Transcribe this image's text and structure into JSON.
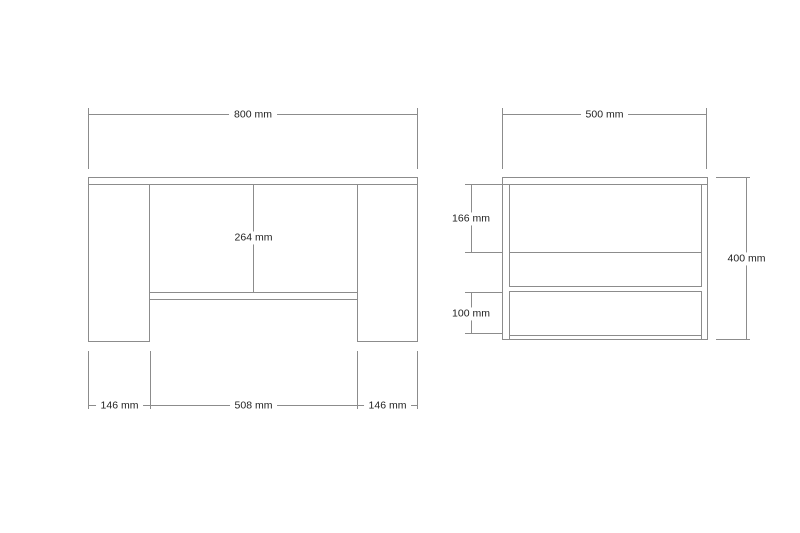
{
  "colors": {
    "line": "#8c8c8c",
    "text": "#1f1f1f",
    "background": "#ffffff"
  },
  "front_view": {
    "overall_width_label": "800 mm",
    "interior_height_label": "264 mm",
    "left_panel_width_label": "146 mm",
    "interior_width_label": "508 mm",
    "right_panel_width_label": "146 mm"
  },
  "side_view": {
    "overall_depth_label": "500 mm",
    "upper_section_label": "166 mm",
    "lower_section_label": "100 mm",
    "overall_height_label": "400 mm"
  }
}
